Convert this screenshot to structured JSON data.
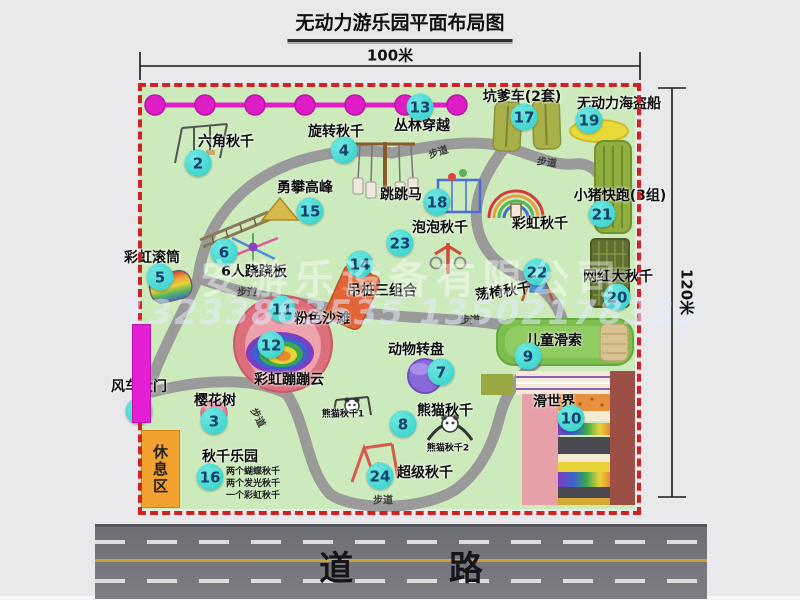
{
  "title": "无动力游乐园平面布局图",
  "dims": {
    "width": "100米",
    "height": "120米"
  },
  "road": {
    "label": "道 路"
  },
  "labels": {
    "path": "步道",
    "rest_area": "休息区",
    "rainbow_swing": "彩虹秋千"
  },
  "watermark": {
    "company": "安游乐设备有限公司",
    "phone": "13233863535 13502178333"
  },
  "colors": {
    "park_bg": "#cdeabd",
    "border_dash": "#cf2222",
    "badge": "#2fcfc8",
    "walkway": "#9a9a9a",
    "chain": "#e01ec8",
    "road": "#73737a",
    "gate": "#e41fd6",
    "rest_area": "#f2a12f"
  },
  "attractions": {
    "windmill_gate": {
      "num": "1",
      "label": "风车大门"
    },
    "hex_swing": {
      "num": "2",
      "label": "六角秋千"
    },
    "cherry_tree": {
      "num": "3",
      "label": "樱花树"
    },
    "rotating_swing": {
      "num": "4",
      "label": "旋转秋千"
    },
    "rainbow_roller": {
      "num": "5",
      "label": "彩虹滚筒"
    },
    "seesaw": {
      "num": "6",
      "label": "6人跷跷板"
    },
    "animal_carousel": {
      "num": "7",
      "label": "动物转盘"
    },
    "panda_swing": {
      "num": "8",
      "label": "熊猫秋千",
      "sub1": "熊猫秋千1",
      "sub2": "熊猫秋千2"
    },
    "kids_zipline": {
      "num": "9",
      "label": "儿童滑索"
    },
    "slide_world": {
      "num": "10",
      "label": "滑世界"
    },
    "pink_beach": {
      "num": "11",
      "label": "粉色沙滩"
    },
    "rainbow_cloud": {
      "num": "12",
      "label": "彩虹蹦蹦云"
    },
    "jungle_crossing": {
      "num": "13",
      "label": "丛林穿越"
    },
    "hanging_piles": {
      "num": "14",
      "label": "吊桩三组合"
    },
    "peak_climb": {
      "num": "15",
      "label": "勇攀高峰"
    },
    "swing_park": {
      "num": "16",
      "label": "秋千乐园",
      "notes": [
        "两个蝴蝶秋千",
        "两个发光秋千",
        "一个彩虹秋千"
      ]
    },
    "pit_car": {
      "num": "17",
      "label": "坑爹车(2套)"
    },
    "jump_horse": {
      "num": "18",
      "label": "跳跳马"
    },
    "pirate_ship": {
      "num": "19",
      "label": "无动力海盗船"
    },
    "big_swing": {
      "num": "20",
      "label": "网红大秋千"
    },
    "pig_run": {
      "num": "21",
      "label": "小猪快跑(3组)"
    },
    "chair_swing": {
      "num": "22",
      "label": "荡椅秋千"
    },
    "bubble_swing": {
      "num": "23",
      "label": "泡泡秋千"
    },
    "super_swing": {
      "num": "24",
      "label": "超级秋千"
    }
  }
}
